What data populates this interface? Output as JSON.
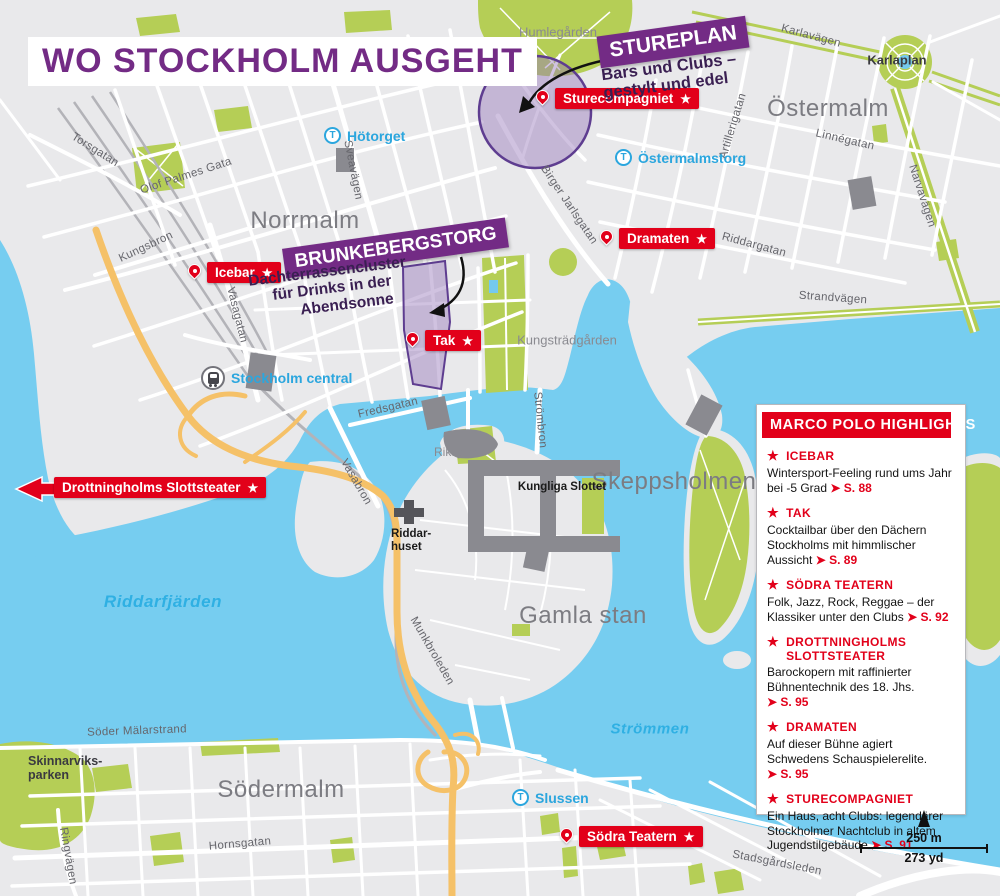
{
  "title": "WO STOCKHOLM AUSGEHT",
  "glyphs": {
    "star": "★",
    "arrow": "➤",
    "t": "T"
  },
  "callouts": {
    "stureplan": {
      "title": "STUREPLAN",
      "line1": "Bars und Clubs –",
      "line2": "gestylt und edel"
    },
    "brunkebergstorg": {
      "title": "BRUNKEBERGSTORG",
      "line1": "Dachterrassencluster",
      "line2": "für Drinks in der",
      "line3": "Abendsonne"
    }
  },
  "pois": {
    "sturecompagniet": "Sturecompagniet",
    "icebar": "Icebar",
    "tak": "Tak",
    "dramaten": "Dramaten",
    "drottningholms": "Drottningholms Slottsteater",
    "sodrateatern": "Södra Teatern"
  },
  "stations": {
    "hotorget": "Hötorget",
    "ostermalmstorg": "Östermalmstorg",
    "slussen": "Slussen",
    "central": "Stockholm central"
  },
  "districts": {
    "norrmalm": "Norrmalm",
    "ostermalm": "Östermalm",
    "skeppsholmen": "Skeppsholmen",
    "gamlastan": "Gamla stan",
    "sodermalm": "Södermalm"
  },
  "areas": {
    "humlegarden": "Humlegården",
    "karlaplan": "Karlaplan",
    "kungstradgarden": "Kungsträdgården",
    "riksplan": "Riksplan",
    "skinnarviksparken1": "Skinnarviks-",
    "skinnarviksparken2": "parken"
  },
  "landmarks": {
    "slottet": "Kungliga Slottet",
    "riddarhuset1": "Riddar-",
    "riddarhuset2": "huset"
  },
  "water": {
    "riddarfjarden": "Riddarfjärden",
    "strommen": "Strömmen"
  },
  "streets": {
    "torsgatan": "Torsgatan",
    "olofpalmes": "Olof Palmes Gata",
    "kungsbron": "Kungsbron",
    "sveavagen": "Sveavägen",
    "vasagatan": "Vasagatan",
    "fredsgatan": "Fredsgatan",
    "vasabron": "Vasabron",
    "strombron": "Strömbron",
    "munkbroleden": "Munkbroleden",
    "birgerjarlsgatan": "Birger Jarlsgatan",
    "artillerigatan": "Artillerigatan",
    "linnegatan": "Linnégatan",
    "karlavagen": "Karlavägen",
    "narvavagen": "Narvavägen",
    "riddargatan": "Riddargatan",
    "strandvagen": "Strandvägen",
    "sodermalarstrand": "Söder Mälarstrand",
    "hornsgatan": "Hornsgatan",
    "ringvagen": "Ringvägen",
    "stadsgardsleden": "Stadsgårdsleden"
  },
  "highlights": {
    "header": "MARCO POLO HIGHLIGHTS",
    "items": [
      {
        "title": "ICEBAR",
        "desc": "Wintersport-Feeling rund ums Jahr bei -5 Grad",
        "page": "S. 88"
      },
      {
        "title": "TAK",
        "desc": "Cocktailbar über den Dächern Stockholms mit himmlischer Aussicht",
        "page": "S. 89"
      },
      {
        "title": "SÖDRA TEATERN",
        "desc": "Folk, Jazz, Rock, Reggae – der Klassiker unter den Clubs",
        "page": "S. 92"
      },
      {
        "title": "DROTTNINGHOLMS SLOTTSTEATER",
        "desc": "Barockopern mit raffinierter Bühnentechnik des 18. Jhs.",
        "page": "S. 95"
      },
      {
        "title": "DRAMATEN",
        "desc": "Auf dieser Bühne agiert Schwedens Schauspielerelite.",
        "page": "S. 95"
      },
      {
        "title": "STURECOMPAGNIET",
        "desc": "Ein Haus, acht Clubs: legendärer Stockholmer Nachtclub in altem Jugendstilgebäude",
        "page": "S. 91"
      }
    ]
  },
  "scalebar": {
    "metric": "250 m",
    "imperial": "273 yd"
  },
  "colors": {
    "purple": "#732B85",
    "red": "#E2001A",
    "cyan": "#2BA6DE",
    "water": "#76CDF0",
    "park": "#B5CE56",
    "land": "#E9E9EB",
    "highway": "#F5C168",
    "building": "#8A8A90"
  }
}
